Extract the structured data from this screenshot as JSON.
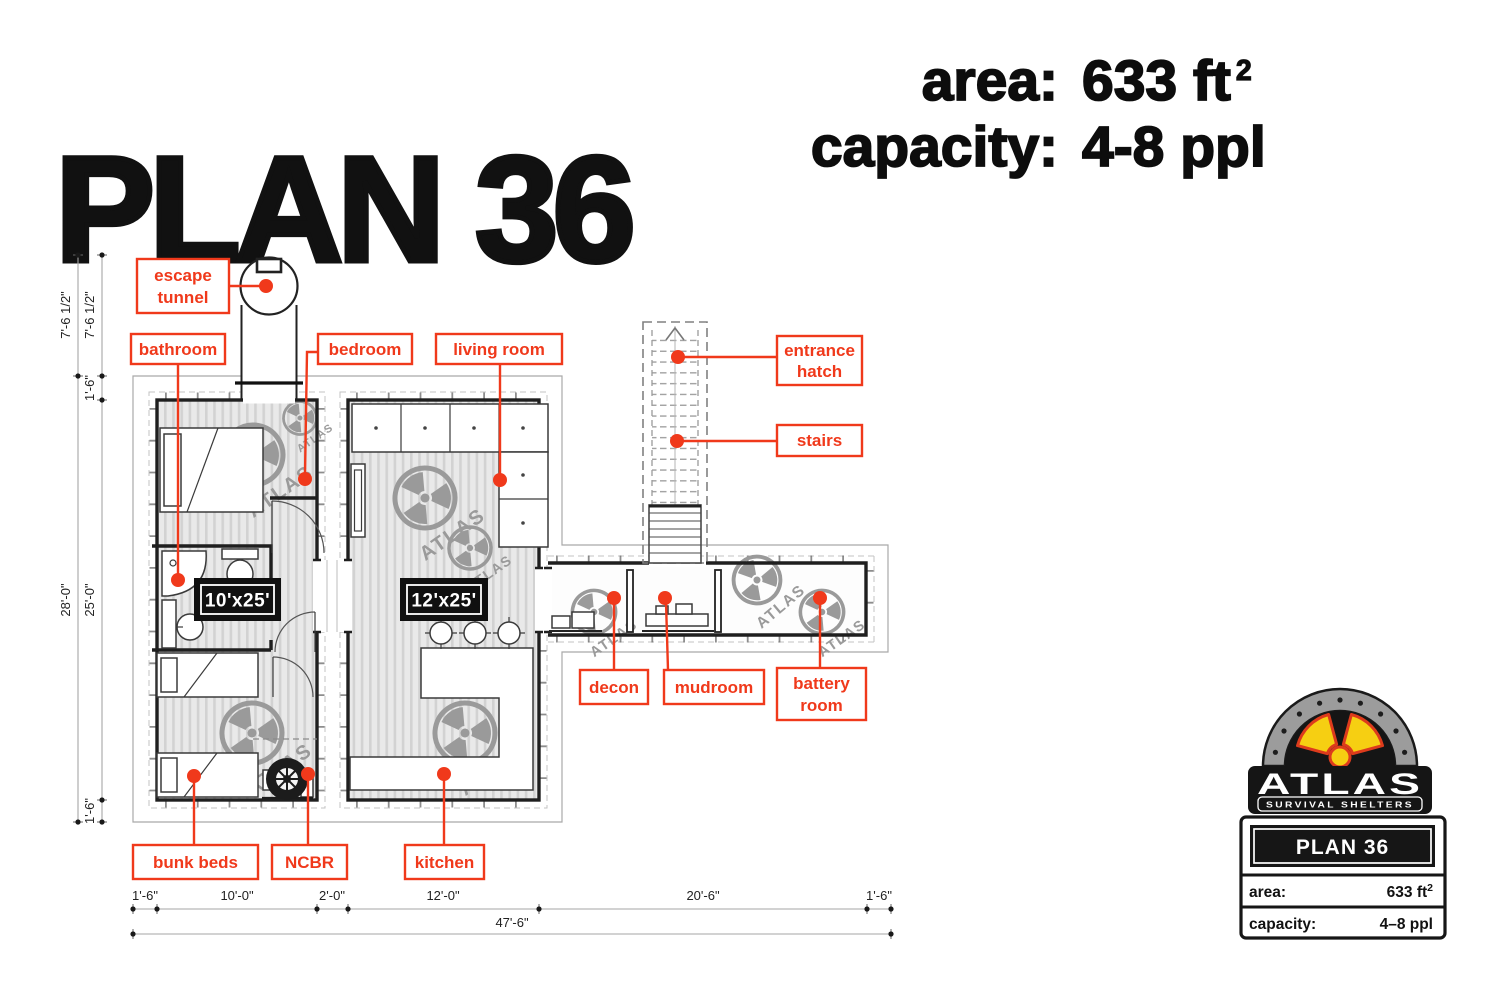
{
  "header": {
    "title": "PLAN 36",
    "specs": [
      {
        "label": "area:",
        "value": "633 ft",
        "sup": "2"
      },
      {
        "label": "capacity:",
        "value": "4-8 ppl",
        "sup": ""
      }
    ]
  },
  "plan": {
    "watermark_text": "ATLAS",
    "size_tags": {
      "left_container": "10'x25'",
      "right_container": "12'x25'"
    },
    "room_labels": {
      "escape_tunnel": {
        "line1": "escape",
        "line2": "tunnel"
      },
      "bathroom": "bathroom",
      "bedroom": "bedroom",
      "living_room": "living room",
      "entrance_hatch": {
        "line1": "entrance",
        "line2": "hatch"
      },
      "stairs": "stairs",
      "decon": "decon",
      "mudroom": "mudroom",
      "battery_room": {
        "line1": "battery",
        "line2": "room"
      },
      "bunk_beds": "bunk beds",
      "ncbr": "NCBR",
      "kitchen": "kitchen"
    },
    "dimensions": {
      "left": {
        "outer_tunnel": "7'-6 1/2\"",
        "inner_tunnel": "7'-6 1/2\"",
        "inner_gap_top": "1'-6\"",
        "outer_total": "28'-0\"",
        "inner_main": "25'-0\"",
        "inner_gap_bottom": "1'-6\""
      },
      "bottom": {
        "segments": [
          "1'-6\"",
          "10'-0\"",
          "2'-0\"",
          "12'-0\"",
          "20'-6\"",
          "1'-6\""
        ],
        "total": "47'-6\""
      }
    }
  },
  "logo": {
    "brand": "ATLAS",
    "tagline": "SURVIVAL SHELTERS",
    "plan_name": "PLAN 36",
    "area_label": "area:",
    "area_value": "633 ft",
    "area_sup": "2",
    "capacity_label": "capacity:",
    "capacity_value": "4–8 ppl"
  },
  "colors": {
    "accent": "#f0391b",
    "wall": "#1f1f1f",
    "logo_yellow": "#f6cf12",
    "logo_red": "#dd3b1c",
    "logo_gray": "#9c9c9c"
  }
}
